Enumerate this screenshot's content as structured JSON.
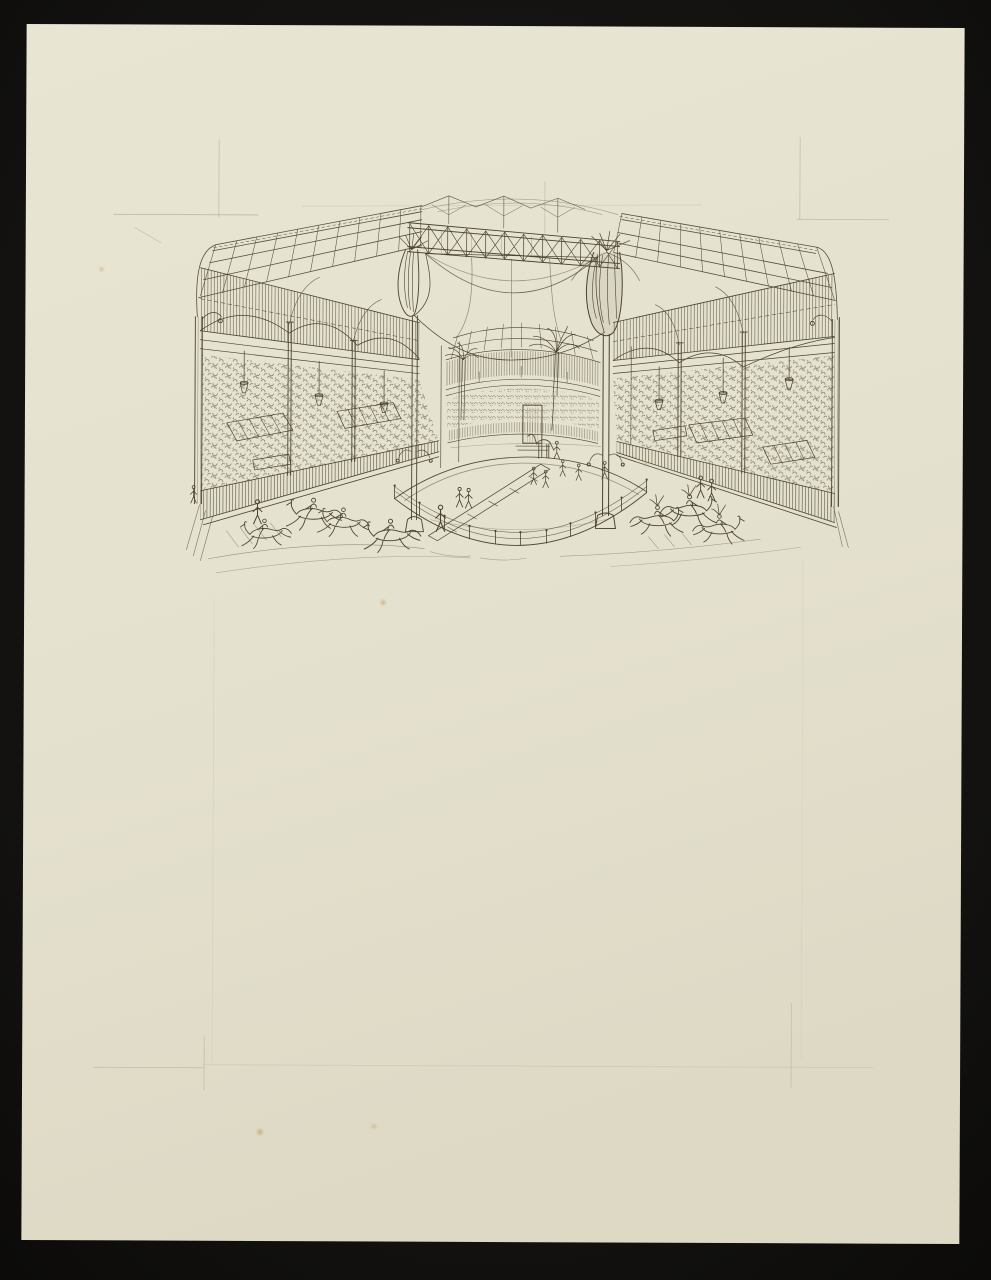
{
  "artwork": {
    "alt": "Pen-and-ink sketch on cream paper, mounted on black: interior of a vast oval iron-and-glass hippodrome hall. An arena ring bounded by a low post-and-rope fence occupies the centre; galloping horses with riders race on the track at left and plumed horses at right. Tiered stands packed with a scribbled crowd line both sides beneath lattice girders, hanging lamps, draped banners and palm decorations. A lattice truss bridge and a draped velum span the central opening, and a small doorway with a led horse stands at the far end. Faint pencil guide lines and a few foxing spots mark the otherwise blank lower sheet.",
    "media_note": "ink over graphite on cream wove paper",
    "mount_note": "black mount"
  },
  "colors": {
    "mount": "#141311",
    "paper": "#e7e3d1",
    "paper_shade": "#dcd8c4",
    "ink": "#49432e",
    "pencil": "#aba68d",
    "foxing": "#c49a52"
  }
}
